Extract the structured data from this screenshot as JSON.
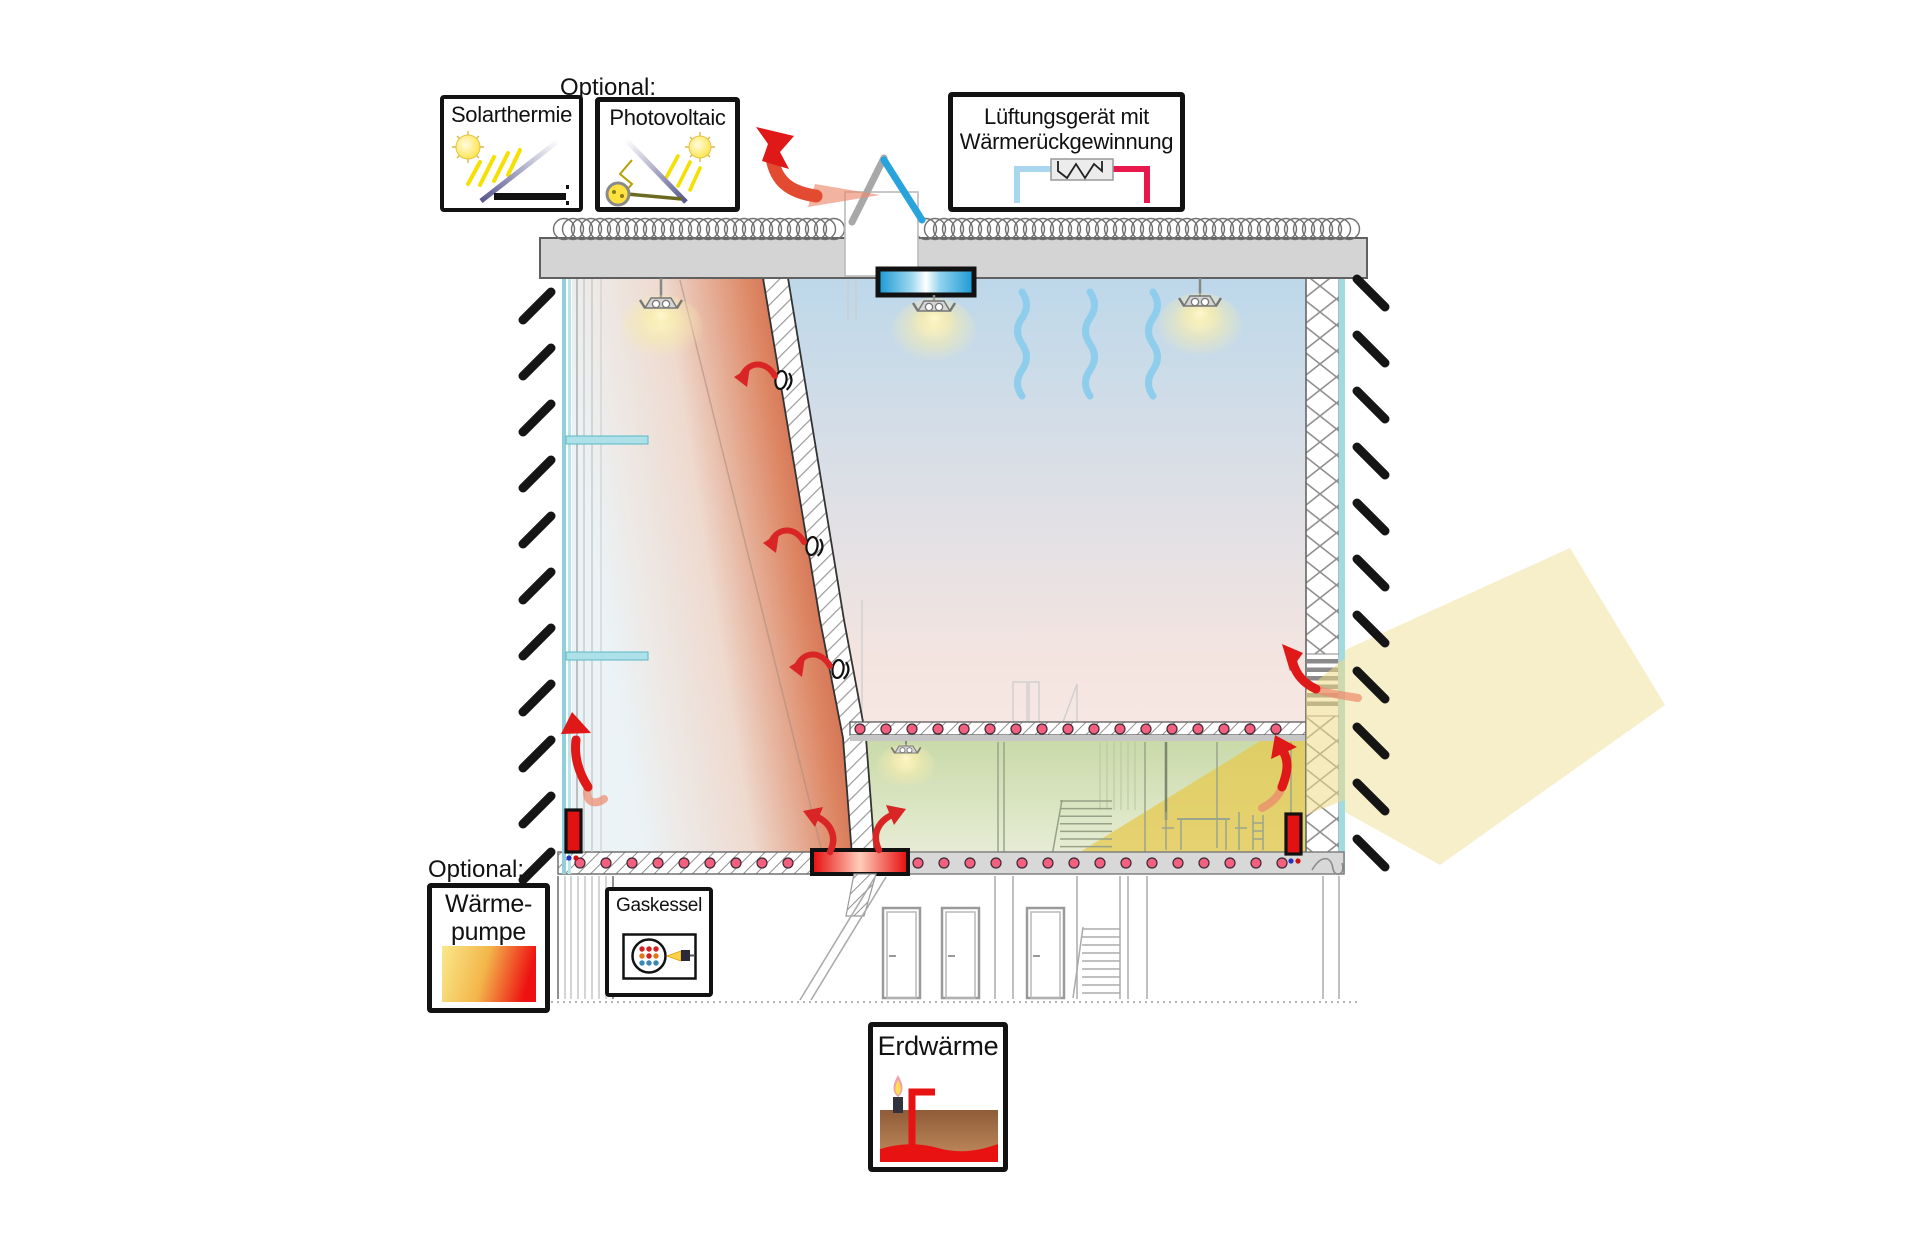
{
  "labels": {
    "optional_top": "Optional:",
    "optional_bottom": "Optional:"
  },
  "legend": {
    "solar_thermal": {
      "label": "Solarthermie",
      "icon": "solar-collector-sun-icon"
    },
    "photovoltaic": {
      "label": "Photovoltaic",
      "icon": "pv-panel-sun-generator-icon"
    },
    "ventilation": {
      "label_line1": "Lüftungsgerät mit",
      "label_line2": "Wärmerückgewinnung",
      "icon": "heat-exchanger-pipes-icon",
      "supply_pipe_color": "#a9d7f0",
      "return_pipe_color": "#e8184c"
    },
    "heat_pump": {
      "label_line1": "Wärme-",
      "label_line2": "pumpe",
      "icon": "heat-gradient-swatch",
      "gradient_from": "#f9e88a",
      "gradient_to": "#ee1111"
    },
    "gas_boiler": {
      "label": "Gaskessel",
      "icon": "gas-burner-icon"
    },
    "geothermal": {
      "label": "Erdwärme",
      "icon": "ground-probe-flame-icon"
    }
  },
  "diagram": {
    "type": "building-section-energy-concept",
    "features": [
      "roof-insulation-coil",
      "roof-vent-flaps",
      "exhaust-air-arrow",
      "supply-air-diffuser",
      "cool-air-downdraft",
      "hanging-lamp",
      "sloped-climbing-wall-vents",
      "warm-air-buffer-zone",
      "glass-facade",
      "underfloor-heating-dots",
      "radiator",
      "floor-convector",
      "sunlight-beam",
      "louver-air-intake",
      "mezzanine-room",
      "basement-doors",
      "staircase",
      "site-hatch-marks",
      "ground-dotted-line"
    ],
    "colors": {
      "warm_air_arrow": "#df1818",
      "warm_air_fade": "#ec8a6e",
      "cool_air": "#8fcdec",
      "warm_zone": "#c95f45",
      "cool_zone_top": "#bdd8ea",
      "hall_bottom": "#f9e9e3",
      "mezzanine_room": "#ccdcae",
      "sun_beam": "#e6c94f",
      "floor_heating_dot": "#f25f7f",
      "glass": "#9fdbe2",
      "air_diffuser_blue": "#1898d4",
      "roof_flap_blue": "#29a3dc",
      "heater_red": "#e60b0b"
    }
  }
}
